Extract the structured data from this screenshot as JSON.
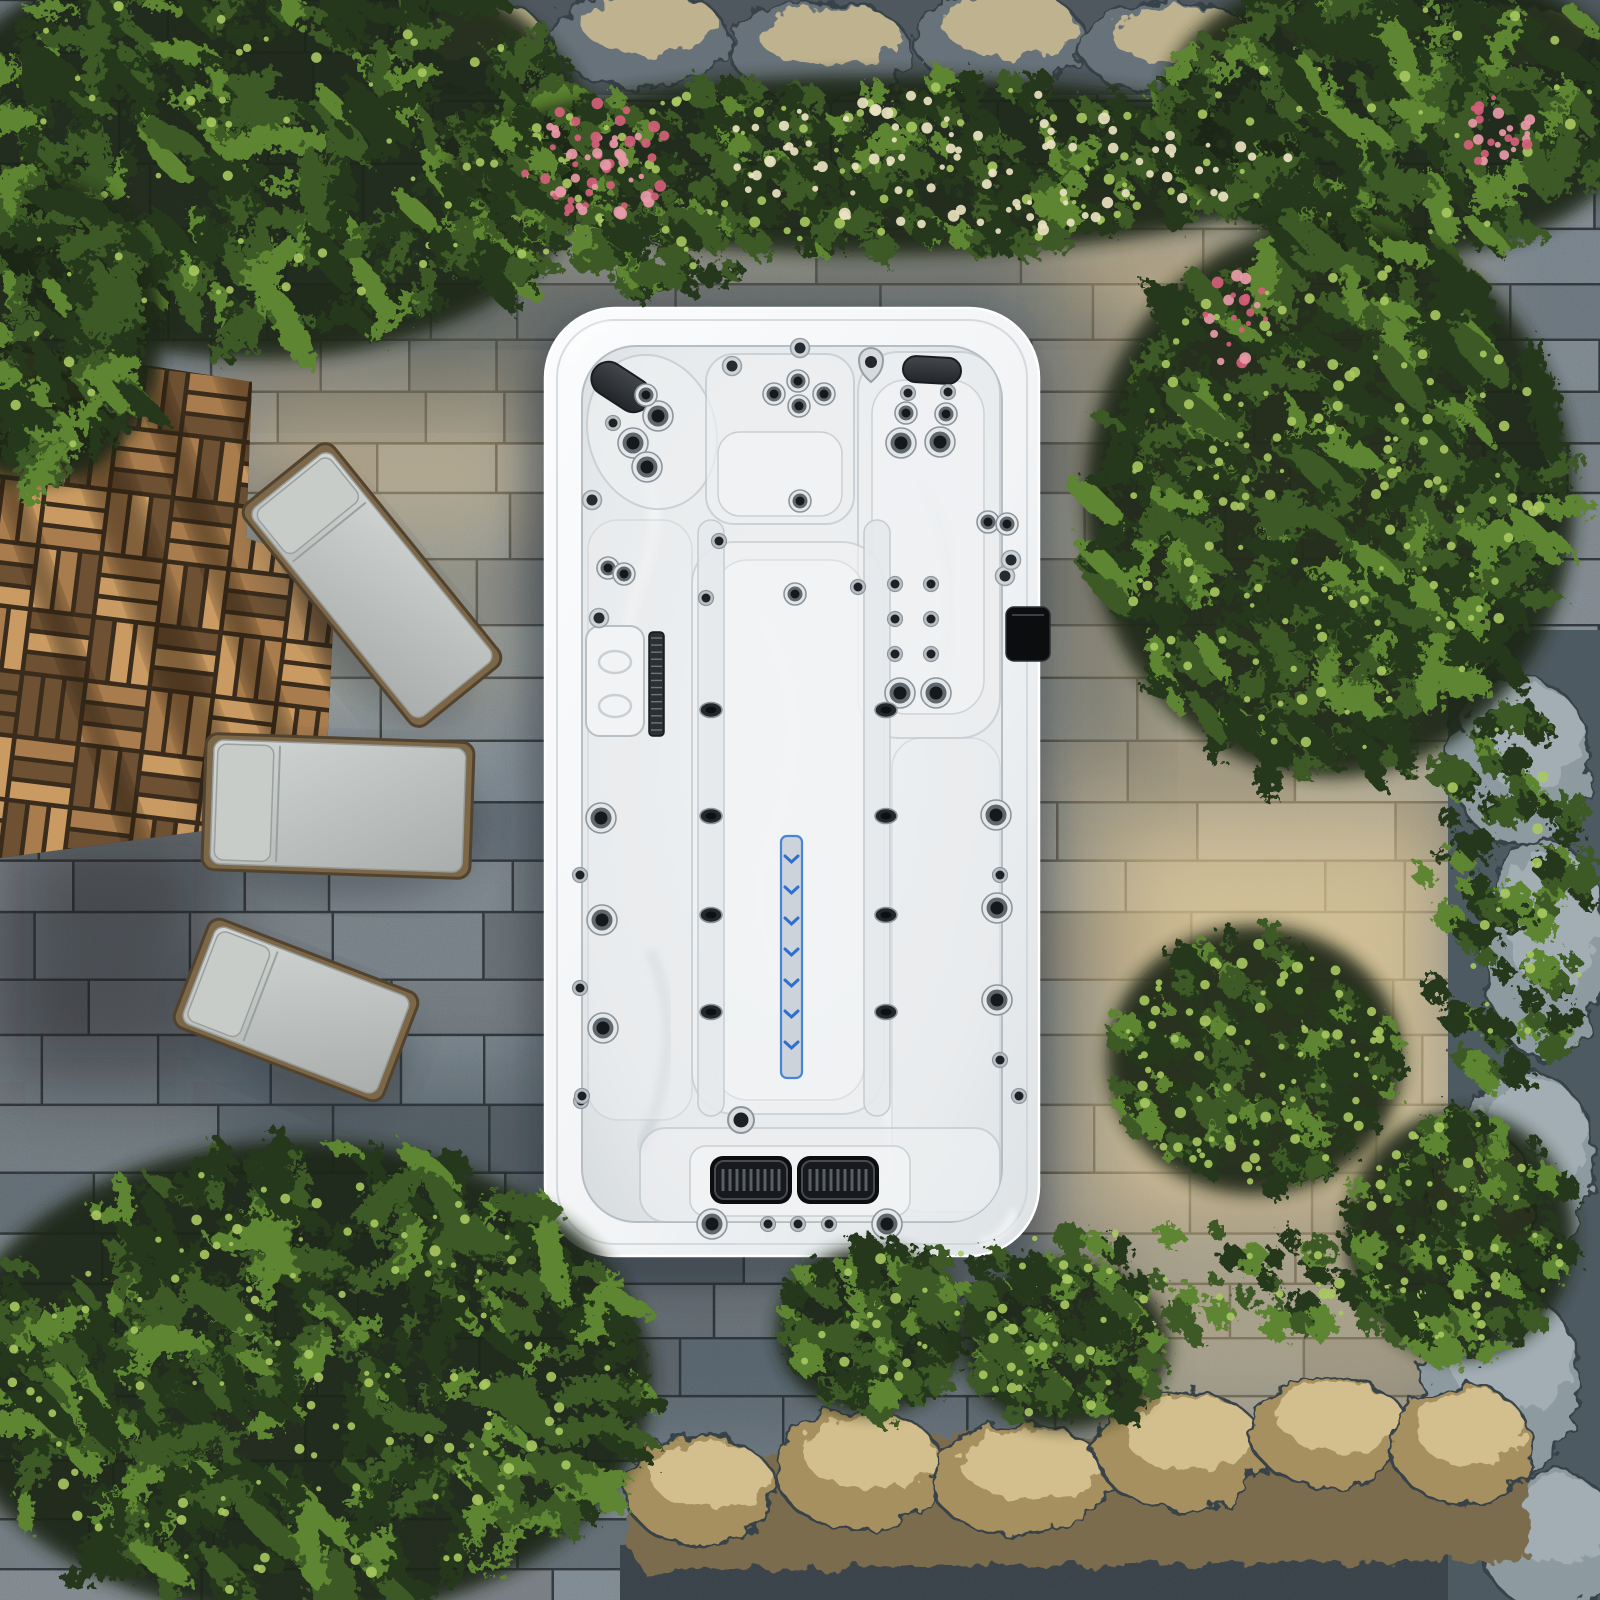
{
  "scene": {
    "description": "Aerial top-down view of a white rectangular swim spa hot tub set on a stone paver patio, bordered by a wooden deck with three grey sun loungers, leafy green shrubs, a flowering hedge with pink and white blooms, a rocky border and sunlit stone ledges",
    "canvas": {
      "width": 1600,
      "height": 1600
    },
    "palette": {
      "paver_joint": "#2f373c",
      "paver_base_l": 52,
      "warm_light": "#eac98b",
      "bright_light": "#f6dca2",
      "cool_shadow": "#202c36",
      "deck_light": "#c99a62",
      "deck_mid": "#a87c4d",
      "deck_dark": "#6e5133",
      "deck_joint": "#3a2c1c",
      "deck_shadow": "#2a1c10",
      "lounger_cushion_hi": "#ced2d0",
      "lounger_cushion_lo": "#aeb3b2",
      "lounger_pillow": "#c8ccc9",
      "lounger_frame": "#7c6748",
      "lounger_frame_edge": "#52432e",
      "foliage_dark": "#26381c",
      "foliage_mid": "#3c5a26",
      "foliage_light": "#5d8530",
      "foliage_sun": "#a8c860",
      "foliage_backdrop": "#1b2814",
      "flower_pink": "#d4607a",
      "flower_pink_light": "#e89aa8",
      "flower_cream": "#e9e2c0",
      "rock_base": "#67727a",
      "rock_band": "#4e585e",
      "rock_lit": "#cfbd92",
      "wall_base": "#4e5a61",
      "wall_rock": "#8d9aa0",
      "ledge_base": "#7a6c4e",
      "ledge_lit": "#dbc795",
      "gravel": "#39434b",
      "shell_hi": "#fafbfc",
      "shell_lo": "#dde2e5",
      "basin_hi": "#eff1f3",
      "basin_lo": "#d7dcdf",
      "contour": "#c2c8cd",
      "headrest": "#2e3236",
      "jet_dark": "#16191c",
      "jet_ring": "#8d959b",
      "led_fill": "#ccd2d9",
      "led_blue": "#3e7fd6"
    },
    "spa": {
      "outer": {
        "x": 545,
        "y": 308,
        "w": 494,
        "h": 948,
        "rx": 70
      },
      "basin": {
        "x": 582,
        "y": 346,
        "w": 420,
        "h": 876,
        "rx": 54
      },
      "headrests": [
        {
          "cx": 621,
          "cy": 387,
          "w": 64,
          "h": 34,
          "rot": 33
        },
        {
          "cx": 932,
          "cy": 370,
          "w": 58,
          "h": 26,
          "rot": 3
        }
      ],
      "control_panel": {
        "x": 1006,
        "y": 607,
        "w": 44,
        "h": 54,
        "rx": 8
      },
      "led_strip": {
        "x": 781,
        "y": 836,
        "w": 21,
        "h": 242,
        "chevron_count": 7,
        "chevron_y0": 856,
        "chevron_step": 31
      },
      "filter_lid": {
        "x": 586,
        "y": 626,
        "w": 58,
        "h": 110,
        "rx": 14
      },
      "filter_grille": {
        "x": 649,
        "y": 632,
        "w": 15,
        "h": 104,
        "tick_count": 14
      },
      "speaker_grilles": {
        "centers": [
          [
            751,
            1180
          ],
          [
            838,
            1180
          ]
        ],
        "w": 72,
        "h": 38,
        "slot_count": 9
      },
      "drain": [
        741,
        1120
      ],
      "teardrop_jet": [
        871,
        360
      ],
      "jets_large": [
        [
          658,
          416
        ],
        [
          633,
          443
        ],
        [
          647,
          467
        ],
        [
          901,
          443
        ],
        [
          940,
          442
        ],
        [
          601,
          818
        ],
        [
          602,
          920
        ],
        [
          603,
          1028
        ],
        [
          996,
          815
        ],
        [
          997,
          908
        ],
        [
          997,
          1000
        ],
        [
          900,
          693
        ],
        [
          936,
          693
        ],
        [
          712,
          1224
        ],
        [
          887,
          1224
        ]
      ],
      "jets_medium": [
        [
          798,
          381
        ],
        [
          774,
          394
        ],
        [
          824,
          394
        ],
        [
          799,
          406
        ],
        [
          906,
          413
        ],
        [
          946,
          414
        ],
        [
          646,
          395
        ],
        [
          800,
          501
        ],
        [
          795,
          594
        ],
        [
          608,
          568
        ],
        [
          624,
          574
        ],
        [
          988,
          522
        ],
        [
          1007,
          524
        ]
      ],
      "jets_small": [
        [
          613,
          423
        ],
        [
          908,
          393
        ],
        [
          948,
          392
        ],
        [
          895,
          584
        ],
        [
          931,
          584
        ],
        [
          895,
          619
        ],
        [
          931,
          619
        ],
        [
          895,
          654
        ],
        [
          931,
          654
        ],
        [
          580,
          875
        ],
        [
          580,
          988
        ],
        [
          581,
          1101
        ],
        [
          1000,
          875
        ],
        [
          1000,
          1060
        ],
        [
          582,
          1096
        ],
        [
          1019,
          1096
        ],
        [
          768,
          1224
        ],
        [
          798,
          1224
        ],
        [
          829,
          1224
        ],
        [
          719,
          541
        ],
        [
          706,
          598
        ],
        [
          858,
          587
        ]
      ],
      "jets_rim": [
        [
          732,
          366
        ],
        [
          800,
          348
        ],
        [
          592,
          500
        ],
        [
          599,
          618
        ],
        [
          1005,
          576
        ],
        [
          1011,
          560
        ]
      ],
      "jets_divider": [
        [
          711,
          710
        ],
        [
          711,
          816
        ],
        [
          711,
          915
        ],
        [
          711,
          1012
        ],
        [
          886,
          710
        ],
        [
          886,
          816
        ],
        [
          886,
          915
        ],
        [
          886,
          1012
        ]
      ]
    },
    "deck": {
      "poly": [
        [
          0,
          342
        ],
        [
          252,
          382
        ],
        [
          246,
          538
        ],
        [
          336,
          568
        ],
        [
          326,
          772
        ],
        [
          216,
          748
        ],
        [
          210,
          830
        ],
        [
          0,
          858
        ]
      ],
      "tile": 64,
      "rotation": 7,
      "shadow_stripes": [
        [
          36,
          26
        ],
        [
          126,
          48
        ],
        [
          214,
          30
        ],
        [
          300,
          62
        ]
      ]
    },
    "loungers": [
      {
        "cx": 372,
        "cy": 585,
        "len": 268,
        "wid": 102,
        "rot": 51
      },
      {
        "cx": 338,
        "cy": 806,
        "len": 252,
        "wid": 124,
        "rot": 2
      },
      {
        "cx": 296,
        "cy": 1010,
        "len": 208,
        "wid": 104,
        "rot": 21
      }
    ],
    "pavers": {
      "row_h_min": 48,
      "row_h_var": 22,
      "block_w_min": 78,
      "block_w_var": 150,
      "hue": 205
    },
    "overlays": [
      {
        "name": "warm-right-band",
        "rect": [
          1048,
          240,
          420,
          1190
        ],
        "color": "#eac98b",
        "op": 0.42
      },
      {
        "name": "warm-top-middle",
        "rect": [
          470,
          205,
          830,
          100
        ],
        "color": "#eac98b",
        "op": 0.3
      },
      {
        "name": "warm-left-of-spa",
        "rect": [
          233,
          330,
          312,
          190
        ],
        "color": "#e6c488",
        "op": 0.4
      },
      {
        "name": "bright-sun-spot",
        "rect": [
          1120,
          830,
          320,
          370
        ],
        "color": "#f6dca2",
        "op": 0.5
      },
      {
        "name": "warm-near-loungers",
        "rect": [
          260,
          470,
          270,
          240
        ],
        "color": "#ecd29a",
        "op": 0.25
      },
      {
        "name": "deck-foot-shadow",
        "rect": [
          0,
          822,
          218,
          260
        ],
        "color": "#1f1812",
        "op": 0.45
      },
      {
        "name": "hedge-shadow",
        "rect": [
          455,
          252,
          610,
          70
        ],
        "color": "#24323c",
        "op": 0.3
      },
      {
        "name": "bush-shadow",
        "rect": [
          1052,
          300,
          90,
          470
        ],
        "color": "#202e36",
        "op": 0.3
      },
      {
        "name": "bottom-cool-shadow",
        "rect": [
          560,
          1240,
          560,
          210
        ],
        "color": "#202c33",
        "op": 0.25
      },
      {
        "name": "canopy-shadow",
        "rect": [
          230,
          300,
          290,
          95
        ],
        "color": "#223038",
        "op": 0.3
      },
      {
        "name": "left-cool-shadow",
        "rect": [
          230,
          1060,
          330,
          250
        ],
        "color": "#242f36",
        "op": 0.3
      }
    ],
    "rocks": {
      "top_band": {
        "rect": [
          420,
          0,
          1180,
          95
        ]
      },
      "top_stones": [
        [
          470,
          45,
          80,
          46
        ],
        [
          640,
          38,
          88,
          50
        ],
        [
          820,
          50,
          92,
          48
        ],
        [
          1000,
          40,
          85,
          52
        ],
        [
          1170,
          48,
          90,
          46
        ],
        [
          1340,
          42,
          88,
          50
        ],
        [
          1510,
          50,
          85,
          48
        ]
      ],
      "right_wall": {
        "rect": [
          1448,
          630,
          152,
          970
        ]
      },
      "wall_stones": [
        [
          1520,
          760,
          70,
          85
        ],
        [
          1545,
          950,
          62,
          110
        ],
        [
          1525,
          1160,
          70,
          90
        ],
        [
          1480,
          1200,
          55,
          70
        ],
        [
          1500,
          1380,
          80,
          95
        ],
        [
          1550,
          1540,
          70,
          70
        ]
      ],
      "bottom_band": {
        "poly": [
          [
            630,
            1545
          ],
          [
            640,
            1440
          ],
          [
            800,
            1455
          ],
          [
            980,
            1430
          ],
          [
            1180,
            1445
          ],
          [
            1360,
            1415
          ],
          [
            1520,
            1430
          ],
          [
            1530,
            1560
          ],
          [
            640,
            1570
          ]
        ]
      },
      "bottom_stones": [
        [
          700,
          1490,
          75,
          55
        ],
        [
          860,
          1470,
          85,
          60
        ],
        [
          1020,
          1480,
          90,
          55
        ],
        [
          1180,
          1450,
          85,
          60
        ],
        [
          1330,
          1432,
          80,
          55
        ],
        [
          1462,
          1445,
          70,
          60
        ]
      ],
      "gravel_poly": [
        [
          620,
          1545
        ],
        [
          1530,
          1505
        ],
        [
          1600,
          1520
        ],
        [
          1600,
          1600
        ],
        [
          620,
          1600
        ]
      ]
    },
    "foliage": {
      "clusters": [
        {
          "name": "canopy-top-left",
          "cx": 260,
          "cy": 150,
          "rx": 330,
          "ry": 205,
          "n": 250,
          "leafy": true,
          "sun": 0.2,
          "backdrop": true
        },
        {
          "name": "canopy-left-edge",
          "cx": 40,
          "cy": 330,
          "rx": 120,
          "ry": 150,
          "n": 90,
          "leafy": true,
          "sun": 0.12,
          "backdrop": true
        },
        {
          "name": "hedge-band",
          "cx": 880,
          "cy": 165,
          "rx": 420,
          "ry": 88,
          "n": 270,
          "leafy": false,
          "sun": 0.3,
          "backdrop": true
        },
        {
          "name": "hedge-left-lobe",
          "cx": 520,
          "cy": 205,
          "rx": 95,
          "ry": 72,
          "n": 70,
          "leafy": false,
          "sun": 0.18,
          "backdrop": false
        },
        {
          "name": "hedge-overhang",
          "cx": 660,
          "cy": 252,
          "rx": 90,
          "ry": 42,
          "n": 46,
          "leafy": false,
          "sun": 0.1,
          "backdrop": false
        },
        {
          "name": "trees-top-right",
          "cx": 1400,
          "cy": 110,
          "rx": 235,
          "ry": 145,
          "n": 170,
          "leafy": true,
          "sun": 0.15,
          "backdrop": true
        },
        {
          "name": "bush-right-big",
          "cx": 1330,
          "cy": 500,
          "rx": 240,
          "ry": 272,
          "n": 300,
          "leafy": true,
          "sun": 0.45,
          "backdrop": true
        },
        {
          "name": "bush-right-lower",
          "cx": 1255,
          "cy": 1060,
          "rx": 145,
          "ry": 132,
          "n": 150,
          "leafy": false,
          "sun": 0.55,
          "backdrop": true
        },
        {
          "name": "bush-right-corner",
          "cx": 1460,
          "cy": 1235,
          "rx": 112,
          "ry": 122,
          "n": 110,
          "leafy": false,
          "sun": 0.4,
          "backdrop": true
        },
        {
          "name": "wall-vine",
          "cx": 1505,
          "cy": 905,
          "rx": 88,
          "ry": 200,
          "n": 90,
          "leafy": false,
          "sun": 0.18,
          "backdrop": false
        },
        {
          "name": "plants-bottom-left",
          "cx": 300,
          "cy": 1380,
          "rx": 345,
          "ry": 235,
          "n": 320,
          "leafy": true,
          "sun": 0.35,
          "backdrop": true
        },
        {
          "name": "bush-bottom-1",
          "cx": 870,
          "cy": 1330,
          "rx": 92,
          "ry": 82,
          "n": 85,
          "leafy": false,
          "sun": 0.2,
          "backdrop": true
        },
        {
          "name": "bush-bottom-2",
          "cx": 1065,
          "cy": 1345,
          "rx": 102,
          "ry": 82,
          "n": 95,
          "leafy": false,
          "sun": 0.3,
          "backdrop": true
        },
        {
          "name": "paver-moss",
          "cx": 1150,
          "cy": 1285,
          "rx": 300,
          "ry": 58,
          "n": 70,
          "leafy": false,
          "sun": 0.4,
          "backdrop": false
        }
      ],
      "flower_clusters": [
        {
          "name": "pink-flowers-main",
          "cx": 595,
          "cy": 160,
          "rx": 78,
          "ry": 58,
          "n": 60,
          "kind": "pink"
        },
        {
          "name": "pink-flowers-top-right",
          "cx": 1490,
          "cy": 130,
          "rx": 42,
          "ry": 36,
          "n": 25,
          "kind": "pink"
        },
        {
          "name": "pink-flowers-right-vine",
          "cx": 1235,
          "cy": 320,
          "rx": 34,
          "ry": 48,
          "n": 22,
          "kind": "pink"
        },
        {
          "name": "white-flower-speckles",
          "cx": 1000,
          "cy": 160,
          "rx": 300,
          "ry": 72,
          "n": 95,
          "kind": "cream"
        }
      ]
    }
  }
}
